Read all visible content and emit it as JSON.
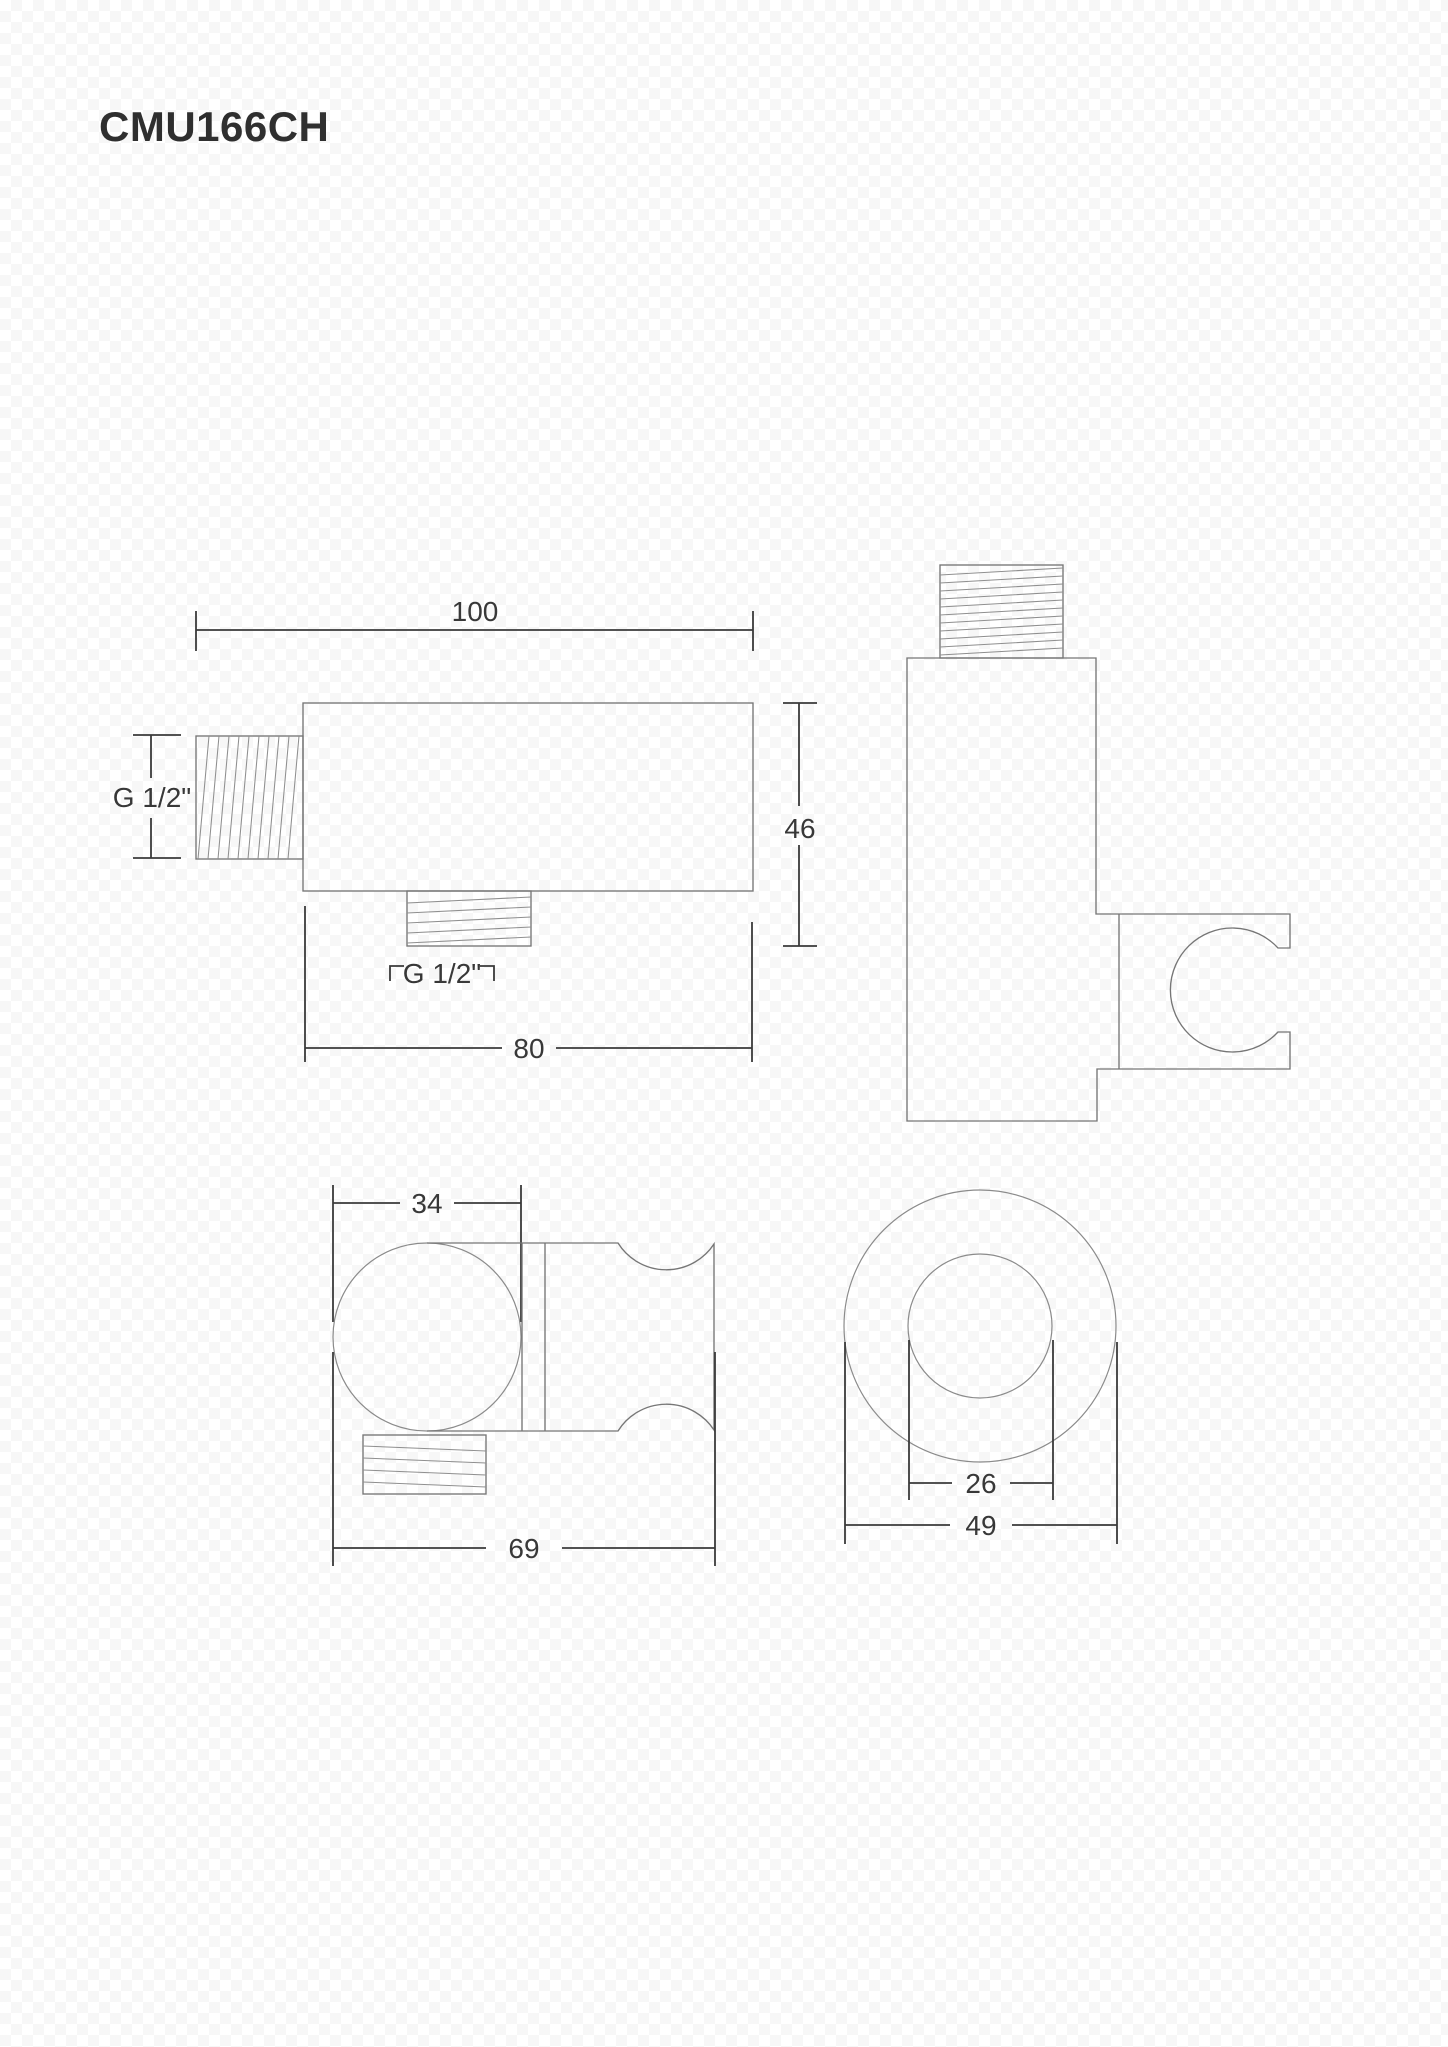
{
  "title": "CMU166CH",
  "front_view": {
    "width_dim": "100",
    "height_dim": "46",
    "body_width_dim": "80",
    "inlet_thread_label": "G 1/2\"",
    "outlet_thread_label": "G 1/2\""
  },
  "plan_view": {
    "body_diameter_dim": "34",
    "overall_width_dim": "69"
  },
  "end_view": {
    "inner_diameter_dim": "26",
    "outer_diameter_dim": "49"
  },
  "colors": {
    "outline": "#767676",
    "dimension": "#3a3a3a",
    "text": "#383838",
    "background": "#ffffff"
  }
}
